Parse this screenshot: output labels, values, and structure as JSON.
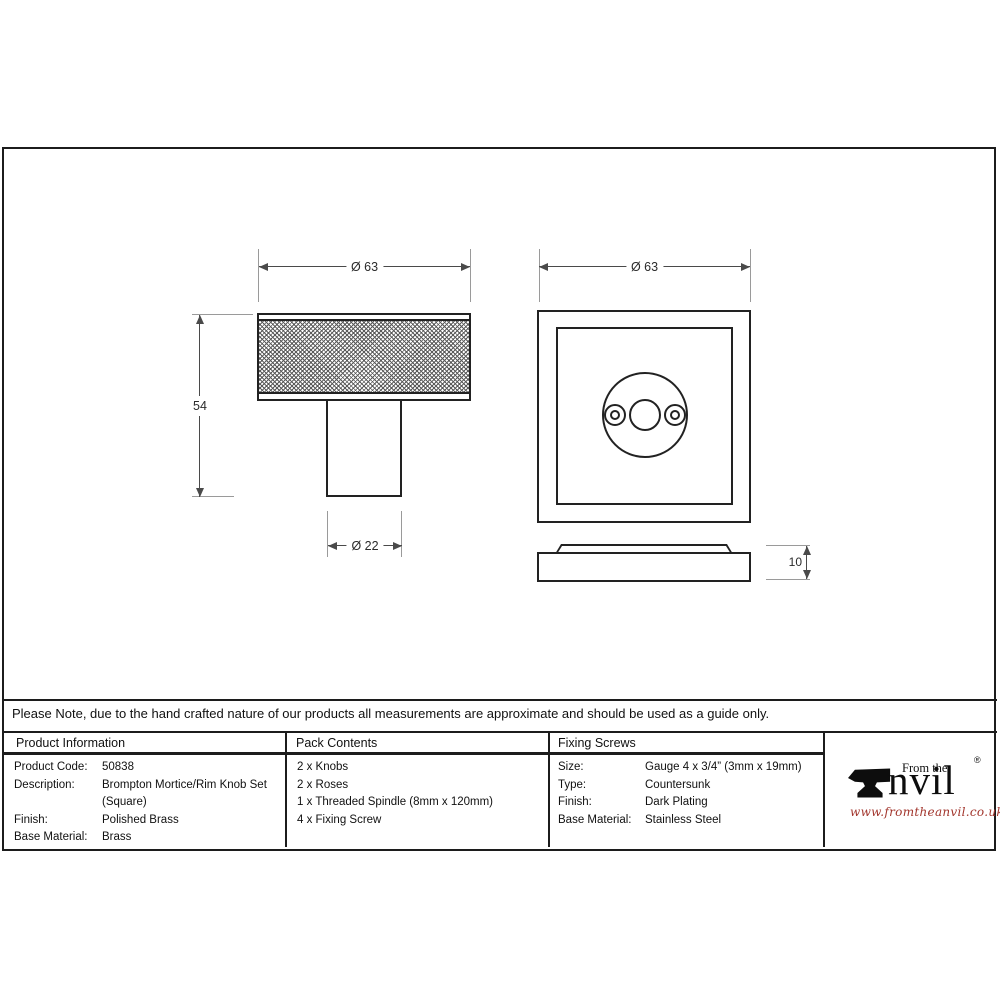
{
  "note_bar": {
    "text": "Please Note, due to the hand crafted nature of our products all measurements are approximate and should be used as a guide only."
  },
  "drawings": {
    "knob_side_view": {
      "diameter_dim": "Ø 63",
      "height_dim": "54",
      "stem_diameter_dim": "Ø 22"
    },
    "rose_front_view": {
      "width_dim": "Ø 63"
    },
    "rose_profile_view": {
      "thickness_dim": "10"
    }
  },
  "table": {
    "product_information": {
      "header": "Product Information",
      "rows": [
        {
          "label": "Product Code:",
          "value": "50838"
        },
        {
          "label": "Description:",
          "value": "Brompton Mortice/Rim Knob Set (Square)"
        },
        {
          "label": "Finish:",
          "value": "Polished Brass"
        },
        {
          "label": "Base Material:",
          "value": "Brass"
        }
      ]
    },
    "pack_contents": {
      "header": "Pack Contents",
      "items": [
        "2 x Knobs",
        "2 x Roses",
        "1 x Threaded Spindle (8mm x 120mm)",
        "4 x Fixing Screw"
      ]
    },
    "fixing_screws": {
      "header": "Fixing Screws",
      "rows": [
        {
          "label": "Size:",
          "value": "Gauge 4 x 3/4” (3mm x 19mm)"
        },
        {
          "label": "Type:",
          "value": "Countersunk"
        },
        {
          "label": "Finish:",
          "value": "Dark Plating"
        },
        {
          "label": "Base Material:",
          "value": "Stainless Steel"
        }
      ]
    }
  },
  "logo": {
    "prefix": "From the",
    "name_rest": "nvil",
    "registered": "®",
    "url": "www.fromtheanvil.co.uk",
    "url_color": "#a2352c",
    "ink_color": "#0d0d0d"
  }
}
